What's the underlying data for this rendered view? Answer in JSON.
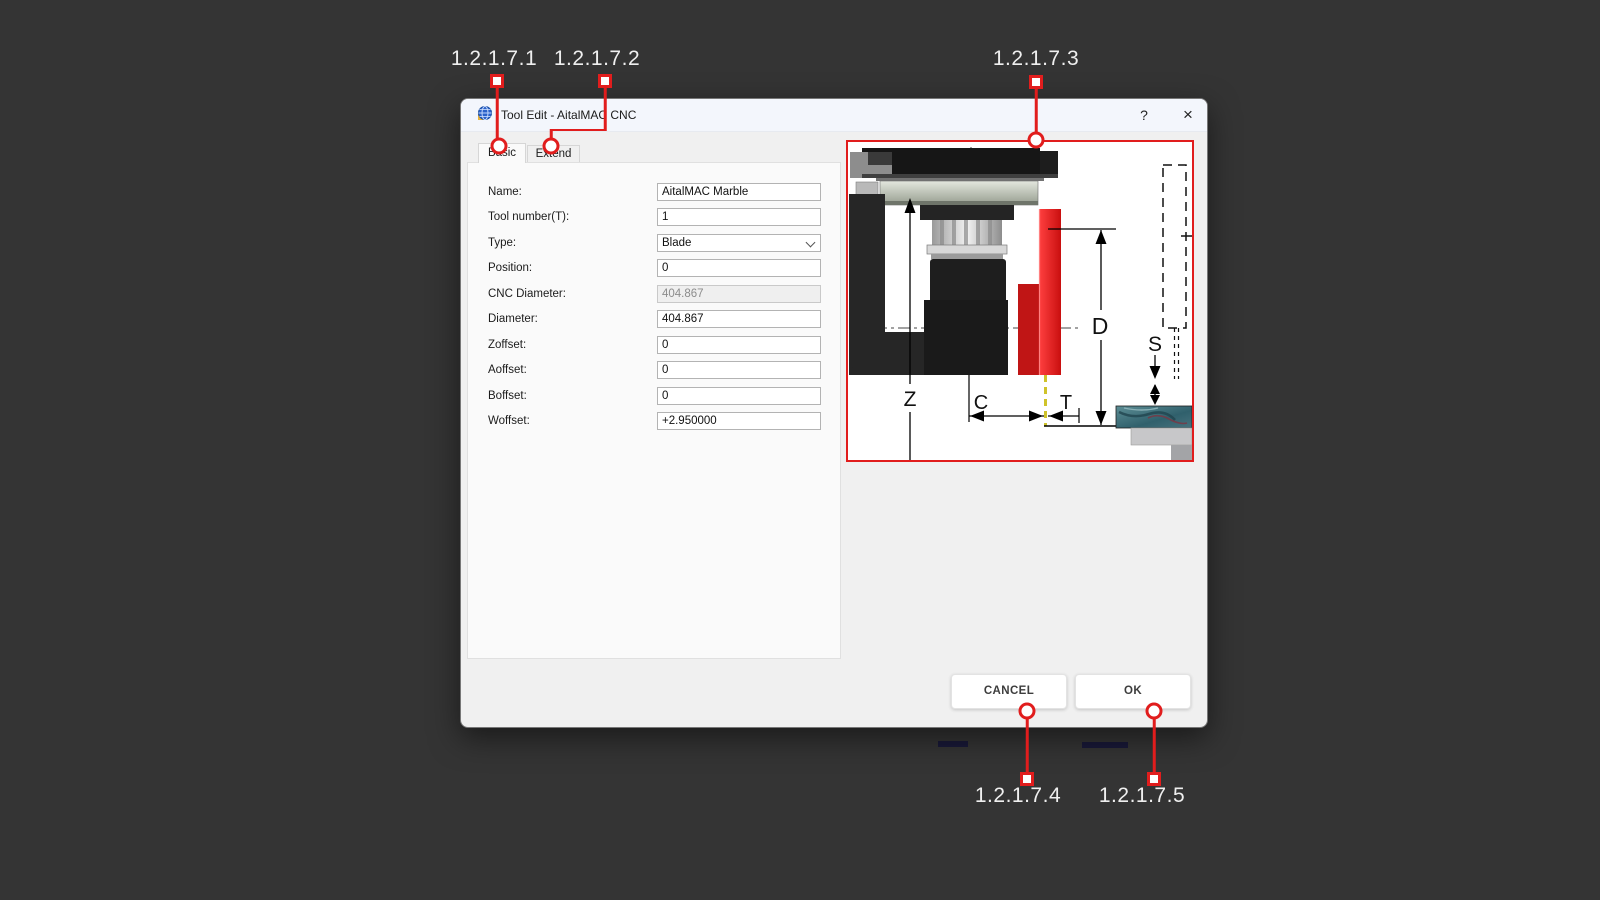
{
  "background_color": "#343434",
  "annotations": {
    "color": "#e11d1d",
    "labels": [
      "1.2.1.7.1",
      "1.2.1.7.2",
      "1.2.1.7.3",
      "1.2.1.7.4",
      "1.2.1.7.5"
    ]
  },
  "window": {
    "title": "Tool Edit - AitalMAC CNC",
    "help_button": "?",
    "close_button": "×",
    "tabs": [
      {
        "label": "Basic",
        "selected": true
      },
      {
        "label": "Extend",
        "selected": false
      }
    ],
    "fields": [
      {
        "label": "Name:",
        "value": "AitalMAC Marble"
      },
      {
        "label": "Tool number(T):",
        "value": "1"
      },
      {
        "label": "Type:",
        "value": "Blade",
        "type": "select"
      },
      {
        "label": "Position:",
        "value": "0"
      },
      {
        "label": "CNC Diameter:",
        "value": "404.867",
        "disabled": true
      },
      {
        "label": "Diameter:",
        "value": "404.867"
      },
      {
        "label": "Zoffset:",
        "value": "0"
      },
      {
        "label": "Aoffset:",
        "value": "0"
      },
      {
        "label": "Boffset:",
        "value": "0"
      },
      {
        "label": "Woffset:",
        "value": "+2.950000"
      }
    ],
    "buttons": {
      "cancel": "CANCEL",
      "ok": "OK"
    },
    "diagram": {
      "border_color": "#e11d1d",
      "dim_labels": {
        "z": "Z",
        "c": "C",
        "t": "T",
        "d": "D",
        "s": "S"
      }
    }
  }
}
